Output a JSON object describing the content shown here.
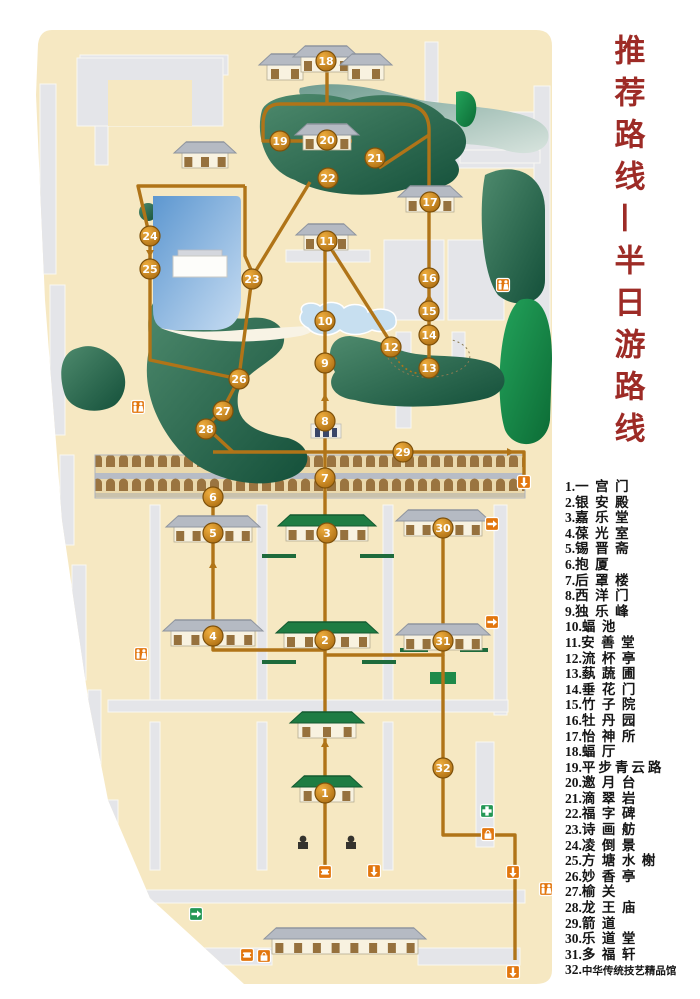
{
  "title": {
    "text": "推荐路线—半日游路线",
    "color": "#9d2b26"
  },
  "legend": {
    "items": [
      {
        "num": "1",
        "name": "一宫门"
      },
      {
        "num": "2",
        "name": "银安殿"
      },
      {
        "num": "3",
        "name": "嘉乐堂"
      },
      {
        "num": "4",
        "name": "葆光室"
      },
      {
        "num": "5",
        "name": "锡晋斋"
      },
      {
        "num": "6",
        "name": "抱厦"
      },
      {
        "num": "7",
        "name": "后罩楼"
      },
      {
        "num": "8",
        "name": "西洋门"
      },
      {
        "num": "9",
        "name": "独乐峰"
      },
      {
        "num": "10",
        "name": "蝠池"
      },
      {
        "num": "11",
        "name": "安善堂"
      },
      {
        "num": "12",
        "name": "流杯亭"
      },
      {
        "num": "13",
        "name": "蓺蔬圃"
      },
      {
        "num": "14",
        "name": "垂花门"
      },
      {
        "num": "15",
        "name": "竹子院"
      },
      {
        "num": "16",
        "name": "牡丹园"
      },
      {
        "num": "17",
        "name": "怡神所"
      },
      {
        "num": "18",
        "name": "蝠厅"
      },
      {
        "num": "19",
        "name": "平步青云路"
      },
      {
        "num": "20",
        "name": "邀月台"
      },
      {
        "num": "21",
        "name": "滴翠岩"
      },
      {
        "num": "22",
        "name": "福字碑"
      },
      {
        "num": "23",
        "name": "诗画舫"
      },
      {
        "num": "24",
        "name": "凌倒景"
      },
      {
        "num": "25",
        "name": "方塘水榭"
      },
      {
        "num": "26",
        "name": "妙香亭"
      },
      {
        "num": "27",
        "name": "榆关"
      },
      {
        "num": "28",
        "name": "龙王庙"
      },
      {
        "num": "29",
        "name": "箭道"
      },
      {
        "num": "30",
        "name": "乐道堂"
      },
      {
        "num": "31",
        "name": "多福轩"
      },
      {
        "num": "32",
        "name": "中华传统技艺精品馆"
      }
    ]
  },
  "map": {
    "colors": {
      "base": "#f6e8c2",
      "route": "#b07418",
      "marker_ring": "#7e510b",
      "hill_dark": "#14503a",
      "hill_light": "#4e8a6d",
      "bright_green": "#18914d",
      "lake_dark": "#5d97d0",
      "lake_light": "#c6dcf2",
      "green_roof": "#1e7c43",
      "gray_roof": "#b5bac3",
      "facility_orange": "#e2760e",
      "facility_green": "#239755"
    },
    "markers": [
      {
        "n": "1",
        "x": 325,
        "y": 793
      },
      {
        "n": "2",
        "x": 325,
        "y": 640
      },
      {
        "n": "3",
        "x": 327,
        "y": 533
      },
      {
        "n": "4",
        "x": 213,
        "y": 636
      },
      {
        "n": "5",
        "x": 213,
        "y": 533
      },
      {
        "n": "6",
        "x": 213,
        "y": 497
      },
      {
        "n": "7",
        "x": 325,
        "y": 478
      },
      {
        "n": "8",
        "x": 325,
        "y": 421
      },
      {
        "n": "9",
        "x": 325,
        "y": 363
      },
      {
        "n": "10",
        "x": 325,
        "y": 321
      },
      {
        "n": "11",
        "x": 327,
        "y": 241
      },
      {
        "n": "12",
        "x": 391,
        "y": 347
      },
      {
        "n": "13",
        "x": 429,
        "y": 368
      },
      {
        "n": "14",
        "x": 429,
        "y": 335
      },
      {
        "n": "15",
        "x": 429,
        "y": 311
      },
      {
        "n": "16",
        "x": 429,
        "y": 278
      },
      {
        "n": "17",
        "x": 430,
        "y": 202
      },
      {
        "n": "18",
        "x": 326,
        "y": 61
      },
      {
        "n": "19",
        "x": 280,
        "y": 141
      },
      {
        "n": "20",
        "x": 327,
        "y": 140
      },
      {
        "n": "21",
        "x": 375,
        "y": 158
      },
      {
        "n": "22",
        "x": 328,
        "y": 178
      },
      {
        "n": "23",
        "x": 252,
        "y": 279
      },
      {
        "n": "24",
        "x": 150,
        "y": 236
      },
      {
        "n": "25",
        "x": 150,
        "y": 269
      },
      {
        "n": "26",
        "x": 239,
        "y": 379
      },
      {
        "n": "27",
        "x": 223,
        "y": 411
      },
      {
        "n": "28",
        "x": 206,
        "y": 429
      },
      {
        "n": "29",
        "x": 403,
        "y": 452
      },
      {
        "n": "30",
        "x": 443,
        "y": 528
      },
      {
        "n": "31",
        "x": 443,
        "y": 641
      },
      {
        "n": "32",
        "x": 443,
        "y": 768
      }
    ],
    "routes": {
      "solid": [
        "M325,870 V422",
        "M325,650 H213 V498",
        "M325,655 H443 V524",
        "M443,655 V835 H515 V960",
        "M325,422 V238",
        "M330,247 L391,343",
        "M429,369 V196",
        "M429,196 V130 Q429,104 400,104 H280 Q263,104 263,124 V141 H352",
        "M327,104 V64",
        "M429,135 L379,168",
        "M310,182 L252,277 L239,377",
        "M245,186 H138 L150,238 V360 L239,379",
        "M245,186 V256 L252,272",
        "M239,379 L223,409 L206,427 L233,452",
        "M213,452 H524 V486"
      ],
      "dashed": [
        "M393,353 C405,375 420,376 429,370"
      ]
    },
    "arrows": [
      {
        "x": 150,
        "y": 253,
        "a": 90
      },
      {
        "x": 325,
        "y": 398,
        "a": -90
      },
      {
        "x": 429,
        "y": 298,
        "a": -90
      },
      {
        "x": 510,
        "y": 452,
        "a": 0
      },
      {
        "x": 325,
        "y": 744,
        "a": -90
      },
      {
        "x": 213,
        "y": 565,
        "a": -90
      }
    ],
    "buildings": [
      {
        "x": 205,
        "y": 142,
        "w": 50,
        "roof": "gray"
      },
      {
        "x": 285,
        "y": 54,
        "w": 40,
        "roof": "gray"
      },
      {
        "x": 326,
        "y": 46,
        "w": 54,
        "roof": "gray"
      },
      {
        "x": 366,
        "y": 54,
        "w": 40,
        "roof": "gray"
      },
      {
        "x": 327,
        "y": 124,
        "w": 52,
        "roof": "gray"
      },
      {
        "x": 430,
        "y": 186,
        "w": 52,
        "roof": "gray"
      },
      {
        "x": 326,
        "y": 224,
        "w": 48,
        "roof": "gray"
      },
      {
        "x": 213,
        "y": 516,
        "w": 82,
        "roof": "gray"
      },
      {
        "x": 327,
        "y": 515,
        "w": 86,
        "roof": "green"
      },
      {
        "x": 443,
        "y": 510,
        "w": 82,
        "roof": "gray"
      },
      {
        "x": 213,
        "y": 620,
        "w": 88,
        "roof": "gray"
      },
      {
        "x": 327,
        "y": 622,
        "w": 90,
        "roof": "green"
      },
      {
        "x": 443,
        "y": 624,
        "w": 82,
        "roof": "gray"
      },
      {
        "x": 327,
        "y": 712,
        "w": 62,
        "roof": "green"
      },
      {
        "x": 327,
        "y": 776,
        "w": 58,
        "roof": "green"
      },
      {
        "x": 345,
        "y": 928,
        "w": 150,
        "roof": "gray"
      }
    ],
    "facilities": [
      {
        "t": "toilet",
        "x": 138,
        "y": 407
      },
      {
        "t": "toilet",
        "x": 503,
        "y": 285
      },
      {
        "t": "toilet",
        "x": 546,
        "y": 889
      },
      {
        "t": "toilet",
        "x": 141,
        "y": 654
      },
      {
        "t": "exit",
        "x": 524,
        "y": 482,
        "a": 90
      },
      {
        "t": "exit",
        "x": 492,
        "y": 524,
        "a": 0
      },
      {
        "t": "exit",
        "x": 492,
        "y": 622,
        "a": 0
      },
      {
        "t": "aid",
        "x": 487,
        "y": 811
      },
      {
        "t": "shop",
        "x": 488,
        "y": 834
      },
      {
        "t": "ticket",
        "x": 325,
        "y": 872
      },
      {
        "t": "exit",
        "x": 374,
        "y": 871,
        "a": 90
      },
      {
        "t": "ticket",
        "x": 247,
        "y": 955
      },
      {
        "t": "shop",
        "x": 264,
        "y": 956
      },
      {
        "t": "exitg",
        "x": 196,
        "y": 914,
        "a": 0
      },
      {
        "t": "exit",
        "x": 513,
        "y": 872,
        "a": 90
      },
      {
        "t": "exit",
        "x": 513,
        "y": 972,
        "a": 90
      }
    ]
  }
}
